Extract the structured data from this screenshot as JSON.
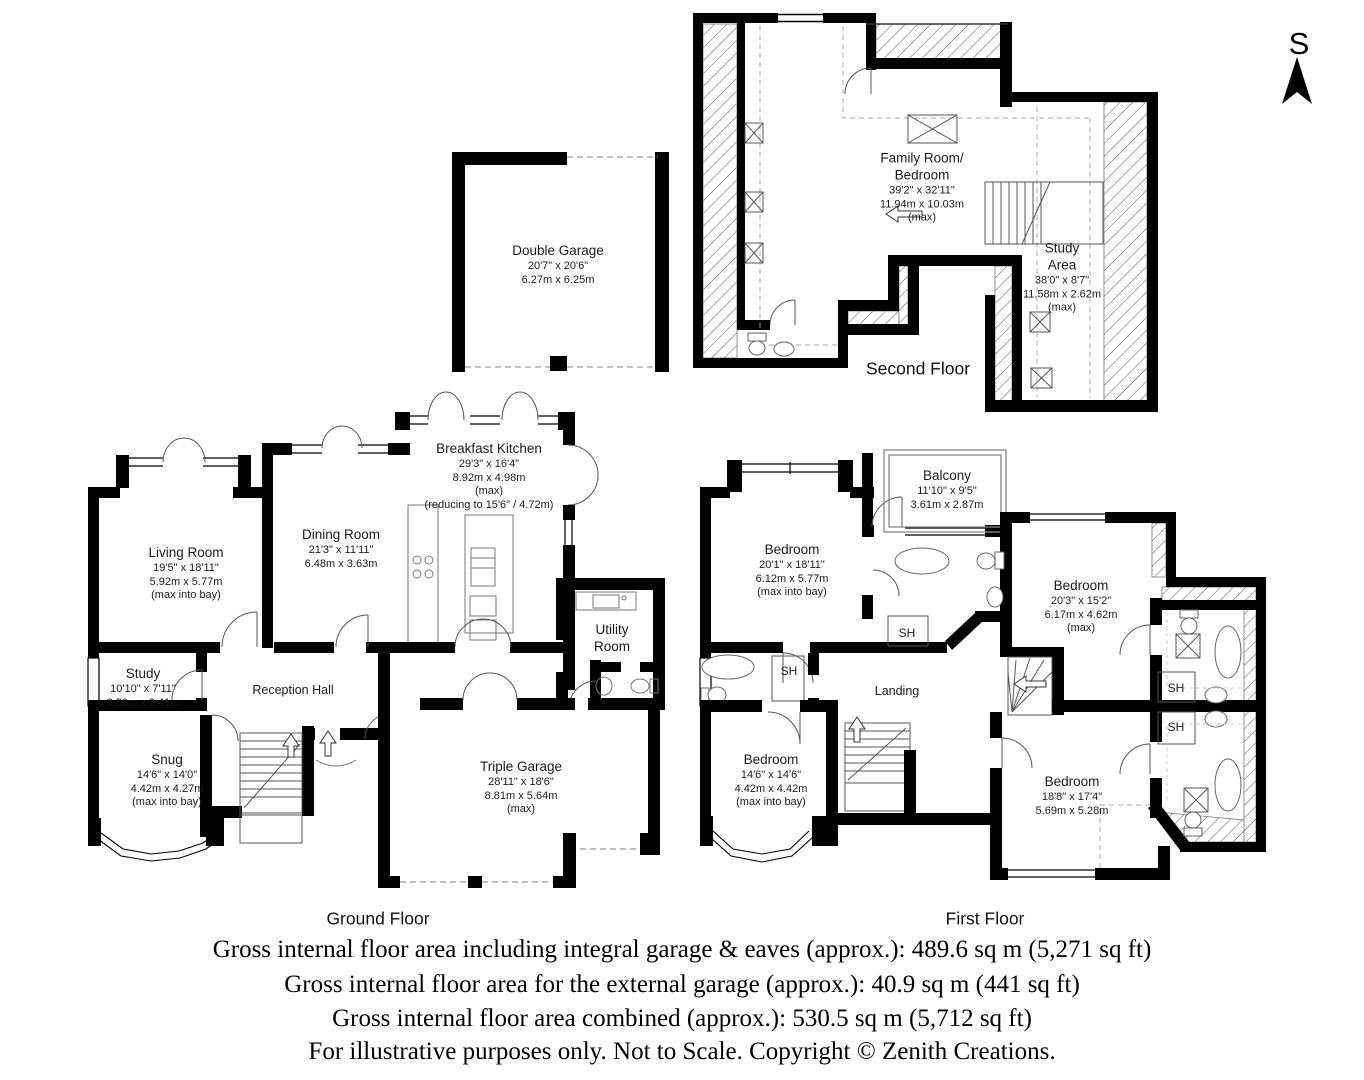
{
  "compass": {
    "label": "S"
  },
  "floors": {
    "second": {
      "title": "Second Floor",
      "family_room": {
        "lines": [
          "Family Room/",
          "Bedroom",
          "39'2\" x 32'11\"",
          "11.94m x 10.03m",
          "(max)"
        ]
      },
      "study_area": {
        "lines": [
          "Study",
          "Area",
          "38'0\" x 8'7\"",
          "11.58m x 2.62m",
          "(max)"
        ]
      }
    },
    "external_garage": {
      "double_garage": {
        "lines": [
          "Double Garage",
          "20'7\" x 20'6\"",
          "6.27m x 6.25m"
        ]
      }
    },
    "ground": {
      "title": "Ground Floor",
      "living_room": {
        "lines": [
          "Living Room",
          "19'5\" x 18'11\"",
          "5.92m x 5.77m",
          "(max into bay)"
        ]
      },
      "dining_room": {
        "lines": [
          "Dining Room",
          "21'3\" x 11'11\"",
          "6.48m x 3.63m"
        ]
      },
      "breakfast_kitchen": {
        "lines": [
          "Breakfast Kitchen",
          "29'3\" x 16'4\"",
          "8.92m x 4.98m",
          "(max)",
          "(reducing to 15'6\" / 4.72m)"
        ]
      },
      "study": {
        "lines": [
          "Study",
          "10'10\" x 7'11\"",
          "3.30m x 2.41m"
        ]
      },
      "reception_hall": {
        "label": "Reception Hall"
      },
      "snug": {
        "lines": [
          "Snug",
          "14'6\" x 14'0\"",
          "4.42m x 4.27m",
          "(max into bay)"
        ]
      },
      "utility_room": {
        "lines": [
          "Utility",
          "Room"
        ]
      },
      "triple_garage": {
        "lines": [
          "Triple Garage",
          "28'11\" x 18'6\"",
          "8.81m x 5.64m",
          "(max)"
        ]
      }
    },
    "first": {
      "title": "First Floor",
      "bedroom_1": {
        "lines": [
          "Bedroom",
          "20'1\" x 18'11\"",
          "6.12m x 5.77m",
          "(max into bay)"
        ]
      },
      "balcony": {
        "lines": [
          "Balcony",
          "11'10\" x 9'5\"",
          "3.61m x 2.87m"
        ]
      },
      "bedroom_2": {
        "lines": [
          "Bedroom",
          "20'3\" x 15'2\"",
          "6.17m x 4.62m",
          "(max)"
        ]
      },
      "landing": {
        "label": "Landing"
      },
      "bedroom_3": {
        "lines": [
          "Bedroom",
          "14'6\" x 14'6\"",
          "4.42m x 4.42m",
          "(max into bay)"
        ]
      },
      "bedroom_4": {
        "lines": [
          "Bedroom",
          "18'8\" x 17'4\"",
          "5.69m x 5.28m"
        ]
      },
      "shower_label": "SH"
    }
  },
  "footer": {
    "lines": [
      "Gross internal floor area including integral garage & eaves (approx.): 489.6 sq m (5,271 sq ft)",
      "Gross internal floor area for the external garage (approx.): 40.9 sq m (441 sq ft)",
      "Gross internal floor area combined (approx.): 530.5 sq m (5,712 sq ft)",
      "For illustrative purposes only. Not to Scale. Copyright © Zenith Creations."
    ]
  }
}
